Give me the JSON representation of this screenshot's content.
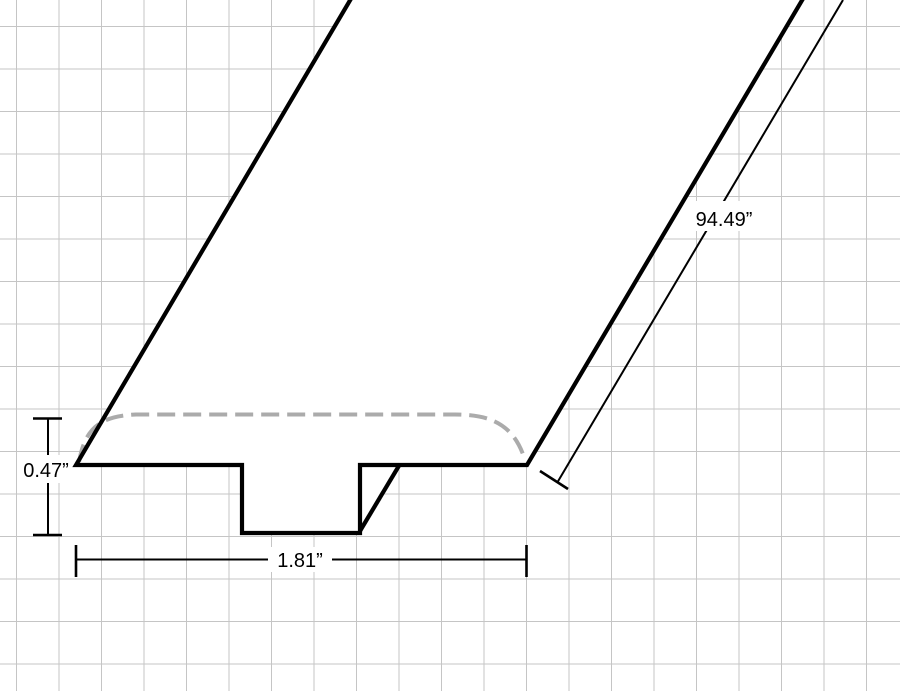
{
  "drawing": {
    "description": "T-molding profile technical drawing in perspective on grid paper",
    "labels": {
      "height": "0.47”",
      "width": "1.81”",
      "length": "94.49”"
    },
    "colors": {
      "background": "#ffffff",
      "grid_line": "#c5c5c5",
      "outline": "#000000",
      "dashed_crown": "#ababab",
      "dimension": "#000000",
      "label_text": "#000000"
    }
  }
}
